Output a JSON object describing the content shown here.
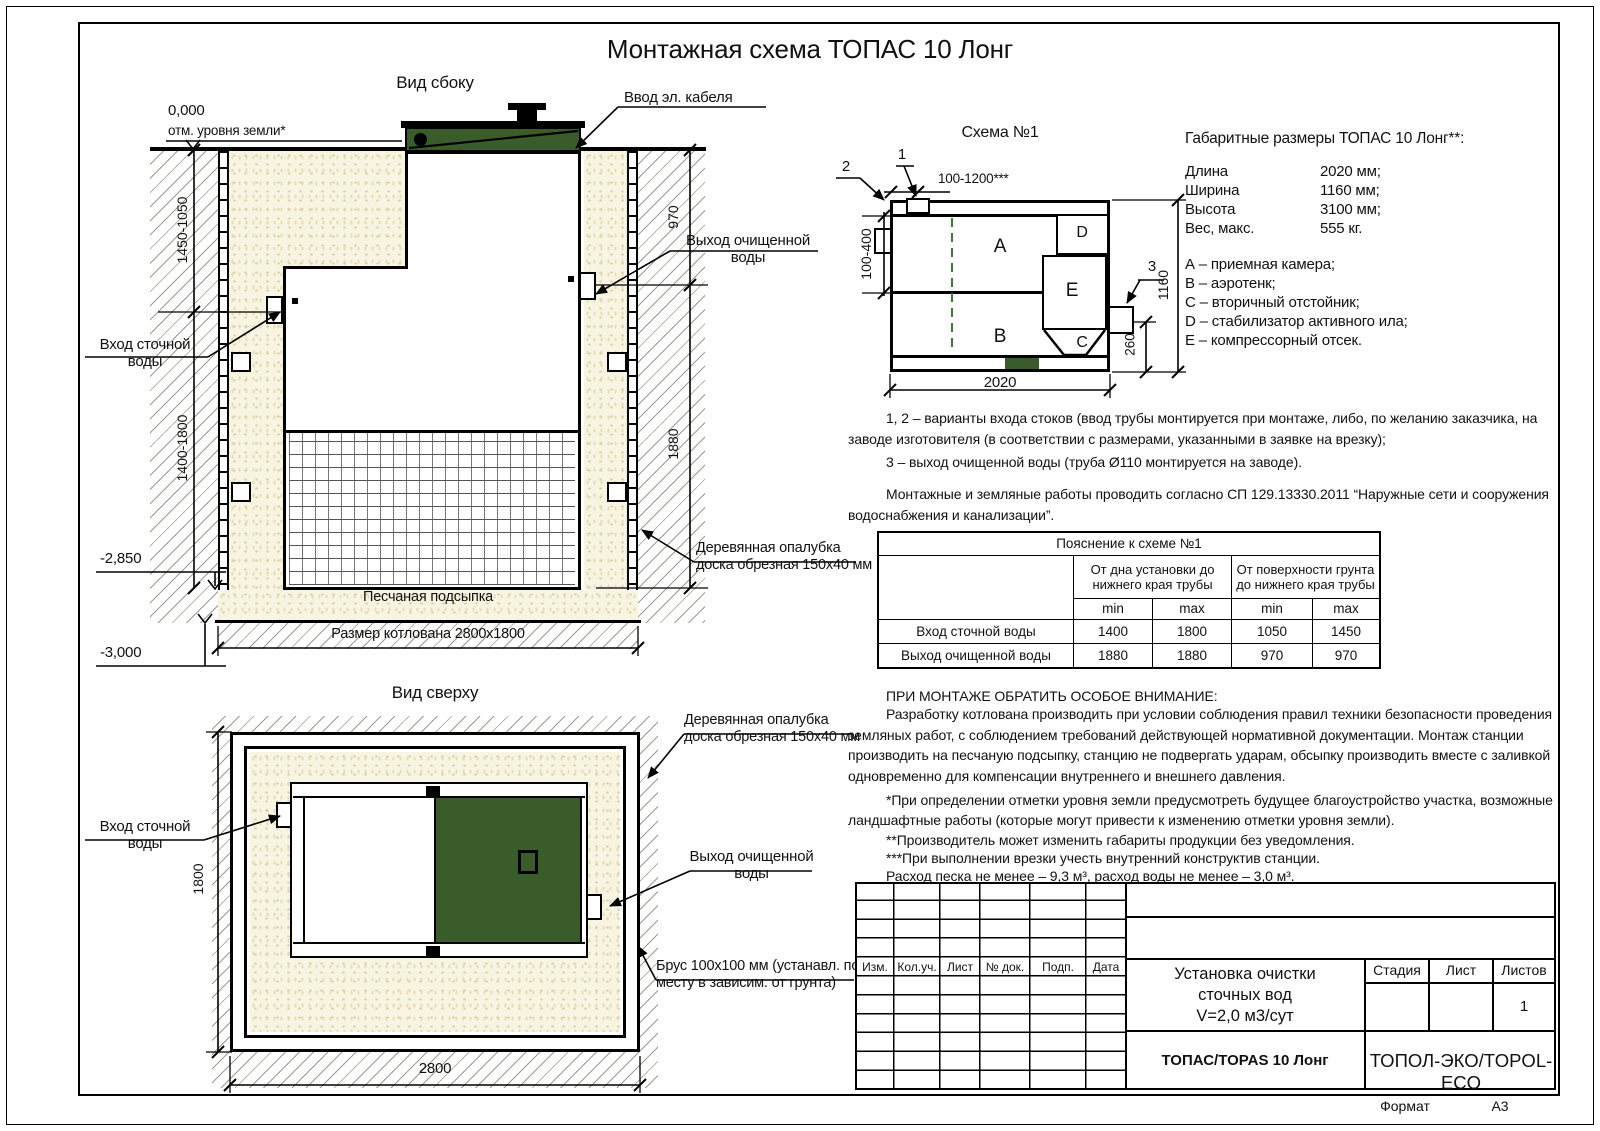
{
  "title": "Монтажная схема ТОПАС 10 Лонг",
  "colors": {
    "green": "#3a5c2a",
    "sand": "#f7f4e1",
    "sand_dot": "#d9cfa2"
  },
  "side_view": {
    "label": "Вид сбоку",
    "level_zero": "0,000",
    "level_zero_sub": "отм. уровня земли*",
    "dim_left_upper": "1450-1050",
    "dim_left_lower": "1400-1800",
    "dim_right_upper": "970",
    "dim_right_lower": "1880",
    "level_bottom1": "-2,850",
    "level_bottom2": "-3,000",
    "sand_label": "Песчаная подсыпка",
    "pit_size_label": "Размер котлована 2800х1800",
    "cable_label": "Ввод эл. кабеля",
    "outlet_label": "Выход очищенной\nводы",
    "inlet_label": "Вход сточной\nводы",
    "formwork_label": "Деревянная опалубка\nдоска обрезная 150х40 мм"
  },
  "top_view": {
    "label": "Вид сверху",
    "dim_width": "2800",
    "dim_height": "1800",
    "inlet_label": "Вход сточной\nводы",
    "outlet_label": "Выход очищенной\nводы",
    "formwork_label": "Деревянная опалубка\nдоска обрезная 150х40 мм",
    "beam_label": "Брус 100х100 мм (устанавл. по\nместу в зависим. от грунта)"
  },
  "schema": {
    "title": "Схема №1",
    "marker1": "1",
    "marker2": "2",
    "marker3": "3",
    "dim_top": "100-1200***",
    "dim_left": "100-400",
    "dim_right": "1160",
    "dim_outlet": "260",
    "dim_bottom": "2020",
    "compartments": [
      "A",
      "B",
      "C",
      "D",
      "E"
    ]
  },
  "dimensions": {
    "title": "Габаритные размеры ТОПАС 10 Лонг**:",
    "rows": [
      {
        "label": "Длина",
        "value": "2020 мм;"
      },
      {
        "label": "Ширина",
        "value": "1160 мм;"
      },
      {
        "label": "Высота",
        "value": "3100 мм;"
      },
      {
        "label": "Вес, макс.",
        "value": "555 кг."
      }
    ],
    "legend": [
      "А – приемная камера;",
      "В – аэротенк;",
      "С – вторичный отстойник;",
      "D – стабилизатор активного ила;",
      "Е – компрессорный отсек."
    ]
  },
  "notes": {
    "note1a": "1, 2 – варианты входа  стоков (ввод трубы монтируется при монтаже, либо, по желанию заказчика, на заводе изготовителя (в соответствии с размерами, указанными в заявке на врезку);",
    "note1b": "3 – выход очищенной воды (труба Ø110 монтируется на заводе).",
    "note2": "Монтажные и земляные работы проводить согласно СП 129.13330.2011 “Наружные сети и сооружения водоснабжения и канализации”."
  },
  "explanation_table": {
    "title": "Пояснение к схеме №1",
    "col_group1": "От дна установки до нижнего края трубы",
    "col_group2": "От поверхности грунта до нижнего края трубы",
    "min_label": "min",
    "max_label": "max",
    "rows": [
      {
        "label": "Вход сточной воды",
        "v1": "1400",
        "v2": "1800",
        "v3": "1050",
        "v4": "1450"
      },
      {
        "label": "Выход очищенной воды",
        "v1": "1880",
        "v2": "1880",
        "v3": "970",
        "v4": "970"
      }
    ]
  },
  "attention": {
    "heading": "ПРИ МОНТАЖЕ ОБРАТИТЬ ОСОБОЕ ВНИМАНИЕ:",
    "p1": "Разработку котлована производить при условии соблюдения правил техники безопасности проведения земляных работ, с соблюдением требований действующей нормативной документации. Монтаж станции производить на песчаную подсыпку, станцию не подвергать ударам, обсыпку производить вместе с заливкой одновременно для компенсации внутреннего и внешнего давления.",
    "p2": "*При определении отметки уровня земли предусмотреть будущее благоустройство участка, возможные ландшафтные работы (которые могут привести к изменению отметки уровня земли).",
    "p3": "**Производитель может изменить габариты продукции без уведомления.",
    "p4": "***При выполнении врезки учесть внутренний конструктив станции.",
    "consumption": "Расход песка не менее – 9,3 м³, расход воды не менее – 3,0 м³."
  },
  "title_block": {
    "cols": [
      "Изм.",
      "Кол.уч.",
      "Лист",
      "№ док.",
      "Подп.",
      "Дата"
    ],
    "doc_title": "Установка очистки\nсточных вод\nV=2,0 м3/сут",
    "stage": "Стадия",
    "sheet": "Лист",
    "sheets": "Листов",
    "sheets_value": "1",
    "model": "ТОПАС/TOPAS 10 Лонг",
    "company": "ТОПОЛ-ЭКО/TOPOL-ECO",
    "format_label": "Формат",
    "format_value": "А3"
  }
}
